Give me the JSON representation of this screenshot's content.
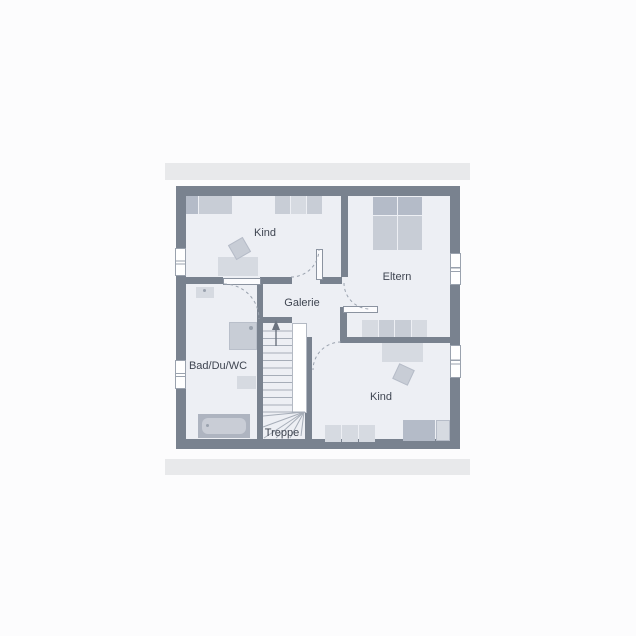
{
  "plan": {
    "rooms": {
      "kind_top": {
        "label": "Kind"
      },
      "eltern": {
        "label": "Eltern"
      },
      "galerie": {
        "label": "Galerie"
      },
      "bad": {
        "label": "Bad/Du/WC"
      },
      "kind_bottom": {
        "label": "Kind"
      },
      "treppe": {
        "label": "Treppe"
      }
    },
    "colors": {
      "bg": "#fcfcfd",
      "eave": "#e8e9eb",
      "wall": "#79828f",
      "floor": "#edeff4",
      "furn_light": "#d6dae1",
      "furn_mid": "#c8cdd6",
      "furn_dark": "#b4bbc8",
      "tub_rim": "#aeb4c0",
      "line": "#9aa2ae",
      "text": "#3f4551"
    },
    "icons": {
      "stairs_direction": "up-arrow-icon"
    }
  }
}
